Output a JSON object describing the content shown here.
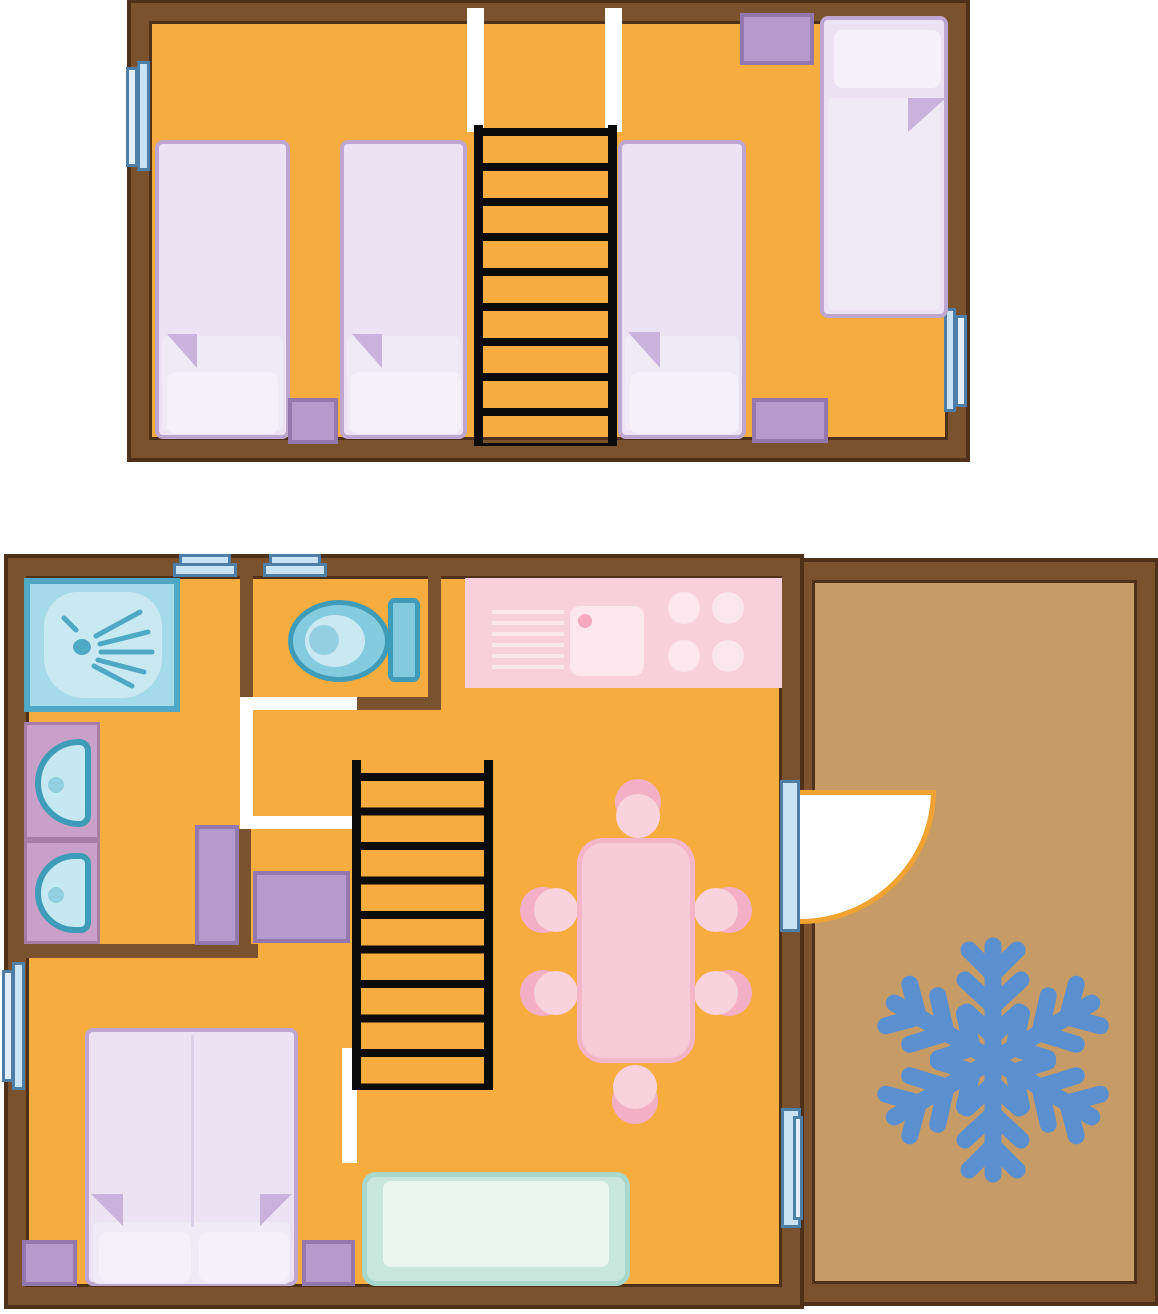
{
  "document": {
    "type": "floor-plan",
    "style": "cartoon top-down chalet plan, two levels, no text labels",
    "levels": [
      "upper floor",
      "ground floor with terrace"
    ]
  },
  "upper_floor": {
    "name": "Upper floor",
    "furniture": {
      "single_beds": 4,
      "bedside_cabinets": 3,
      "ladder_staircase_rungs": 10,
      "stairwell_opening_rails": 2,
      "windows": 2
    }
  },
  "ground_floor": {
    "name": "Ground floor",
    "bathroom": {
      "shower": 1,
      "washbasins": 2,
      "vanity_units": 2
    },
    "wc": {
      "toilet": 1
    },
    "kitchen": {
      "hob_burners": 4,
      "sink": 1,
      "draining_board": 1
    },
    "living_dining": {
      "dining_table": 1,
      "chairs": 6,
      "sofa": 1,
      "ladder_staircase_rungs": 10
    },
    "bedroom": {
      "double_bed": 1,
      "pillows": 2,
      "bedside_cabinets": 2
    },
    "storage_cabinets": 2,
    "windows": 4,
    "terrace_door": 1
  },
  "terrace": {
    "name": "Terrace",
    "rug_icon": "snowflake-icon"
  },
  "icons": [
    "snowflake-icon",
    "shower-spray-icon"
  ],
  "colors": {
    "floor": "#F6AC3E",
    "wall": "#7B522E",
    "wallDark": "#4F3119",
    "terrace": "#C79B66",
    "bedFill": "#ECE2F3",
    "bedBorder": "#BDA7D0",
    "pillow": "#F6F0FA",
    "blanket": "#F0E9F6",
    "fold": "#C9B3DC",
    "purple": "#B49BCB",
    "purpleBorder": "#9478AD",
    "winBlue": "#C9E2F4",
    "winLight": "#E3EEF9",
    "winBorder": "#4E7FA8",
    "tealDark": "#3E9CB8",
    "tealMid": "#85CBE0",
    "tealLight": "#C9E9F2",
    "showerFill": "#A5DAE8",
    "spray": "#4FA8C4",
    "sinkBody": "#C6E8F2",
    "drain": "#93CFE0",
    "counter": "#C9A0C9",
    "counterBorder": "#A77CA7",
    "kitchen": "#F8D0DC",
    "kitchenItem": "#FBE7ED",
    "faucet": "#F4A9C1",
    "table": "#F7CBD7",
    "tableBorder": "#F3B6C9",
    "chairBack": "#F2AFC6",
    "chairSeat": "#F8D2DC",
    "sofaBorder": "#A7D8CB",
    "sofaFill": "#C9E6DD",
    "sofaInner": "#EAF5F0",
    "snowflake": "#5A8FD0",
    "stairs": "#0B0B0B",
    "doorArc": "#F0A330",
    "opening": "#FFFFFF"
  }
}
